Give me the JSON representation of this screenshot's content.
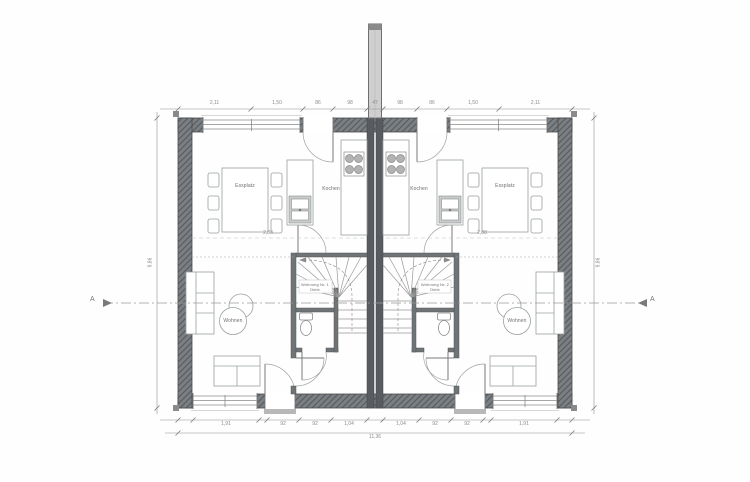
{
  "plan": {
    "section_marker": "A",
    "units": [
      {
        "dining_label": "Essplatz",
        "kitchen_label": "Kochen",
        "living_label": "Wohnen",
        "hall_label_line1": "Wohnung Nr. 1",
        "hall_label_line2": "Diele"
      },
      {
        "dining_label": "Essplatz",
        "kitchen_label": "Kochen",
        "living_label": "Wohnen",
        "hall_label_line1": "Wohnung Nr. 2",
        "hall_label_line2": "Diele"
      }
    ],
    "dimensions": {
      "top_segments": [
        "2,11",
        "1,50",
        "86",
        "98",
        "47",
        "98",
        "86",
        "1,50",
        "2,11"
      ],
      "bottom_segments": [
        "1,91",
        "92",
        "92",
        "1,04",
        "1,04",
        "92",
        "92",
        "1,91"
      ],
      "bottom_total": "11,36",
      "left_total": "9,86",
      "right_total": "9,86",
      "interior_left": "2,88",
      "interior_right": "2,88"
    },
    "colors": {
      "wall_dark": "#585c60",
      "wall_hatch_bg": "#7a7f83",
      "line": "#8b8b8b",
      "furniture": "#9aa0a0",
      "dim": "#8c8c8c",
      "text": "#6f6f6f"
    }
  }
}
